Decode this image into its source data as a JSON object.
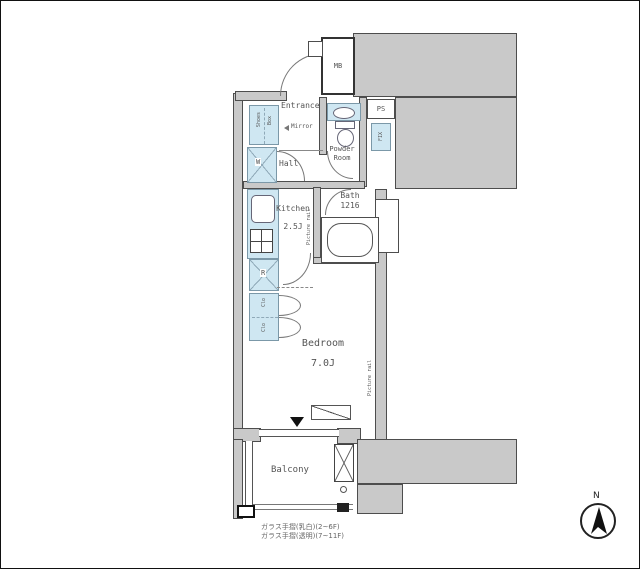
{
  "plan": {
    "colors": {
      "wall_fill": "#c9c9c9",
      "fixture_fill": "#cfe7f2",
      "fixture_border": "#7b98a8",
      "line": "#4d4d4d",
      "text": "#555555",
      "black": "#1a1a1a"
    },
    "labels": {
      "mb": "MB",
      "ps": "PS",
      "fix": "FIX",
      "entrance": "Entrance",
      "mirror": "Mirror",
      "hall": "Hall",
      "powder_line1": "Powder",
      "powder_line2": "Room",
      "bath_name": "Bath",
      "bath_size": "1216",
      "kitchen_name": "Kitchen",
      "kitchen_size": "2.5J",
      "bedroom_name": "Bedroom",
      "bedroom_size": "7.0J",
      "balcony": "Balcony",
      "washer": "W",
      "fridge": "R",
      "closet_upper": "Clo",
      "closet_lower": "Clo",
      "shoes_line1": "Shoes",
      "shoes_line2": "Box",
      "picture_rail_kitchen": "Picture rail",
      "picture_rail_bedroom": "Picture rail",
      "compass_north": "N"
    },
    "notes": {
      "line1": "ガラス手摺(乳白)(2~6F)",
      "line2": "ガラス手摺(透明)(7~11F)"
    }
  }
}
